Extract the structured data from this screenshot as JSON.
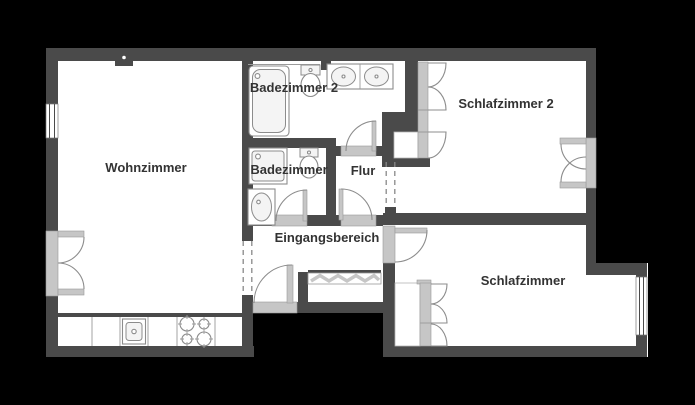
{
  "plan": {
    "type": "apartment-floor-plan",
    "language": "de"
  },
  "colors": {
    "background": "#000000",
    "wall": "#4a4a4a",
    "floor": "#ffffff",
    "sill": "#c6c6c6",
    "line": "#8c8c8c",
    "text": "#333333"
  },
  "rooms": [
    {
      "id": "wohnzimmer",
      "label": "Wohnzimmer"
    },
    {
      "id": "badezimmer-2",
      "label": "Badezimmer 2"
    },
    {
      "id": "badezimmer",
      "label": "Badezimmer"
    },
    {
      "id": "flur",
      "label": "Flur"
    },
    {
      "id": "eingangsbereich",
      "label": "Eingangsbereich"
    },
    {
      "id": "schlafzimmer-2",
      "label": "Schlafzimmer 2"
    },
    {
      "id": "schlafzimmer",
      "label": "Schlafzimmer"
    }
  ],
  "fixtures": [
    {
      "id": "bathtub",
      "room": "Badezimmer 2"
    },
    {
      "id": "toilet",
      "room": "Badezimmer 2"
    },
    {
      "id": "double-washbasin",
      "room": "Badezimmer 2"
    },
    {
      "id": "shower-tray",
      "room": "Badezimmer"
    },
    {
      "id": "toilet",
      "room": "Badezimmer"
    },
    {
      "id": "washbasin",
      "room": "Badezimmer"
    },
    {
      "id": "kitchen-counter",
      "room": "Wohnzimmer"
    },
    {
      "id": "kitchen-sink",
      "room": "Wohnzimmer"
    },
    {
      "id": "stove-four-burners",
      "room": "Wohnzimmer"
    },
    {
      "id": "chimney-flue",
      "room": "Wohnzimmer"
    },
    {
      "id": "coat-rack-wardrobe",
      "room": "Eingangsbereich"
    },
    {
      "id": "built-in-wardrobe",
      "room": "Schlafzimmer 2"
    },
    {
      "id": "built-in-wardrobe",
      "room": "Schlafzimmer"
    },
    {
      "id": "french-balcony-door",
      "room": "Wohnzimmer"
    },
    {
      "id": "french-balcony-door",
      "room": "Schlafzimmer 2"
    },
    {
      "id": "window",
      "room": "Wohnzimmer"
    },
    {
      "id": "window",
      "room": "Schlafzimmer"
    },
    {
      "id": "entrance-door",
      "room": "Eingangsbereich"
    }
  ]
}
